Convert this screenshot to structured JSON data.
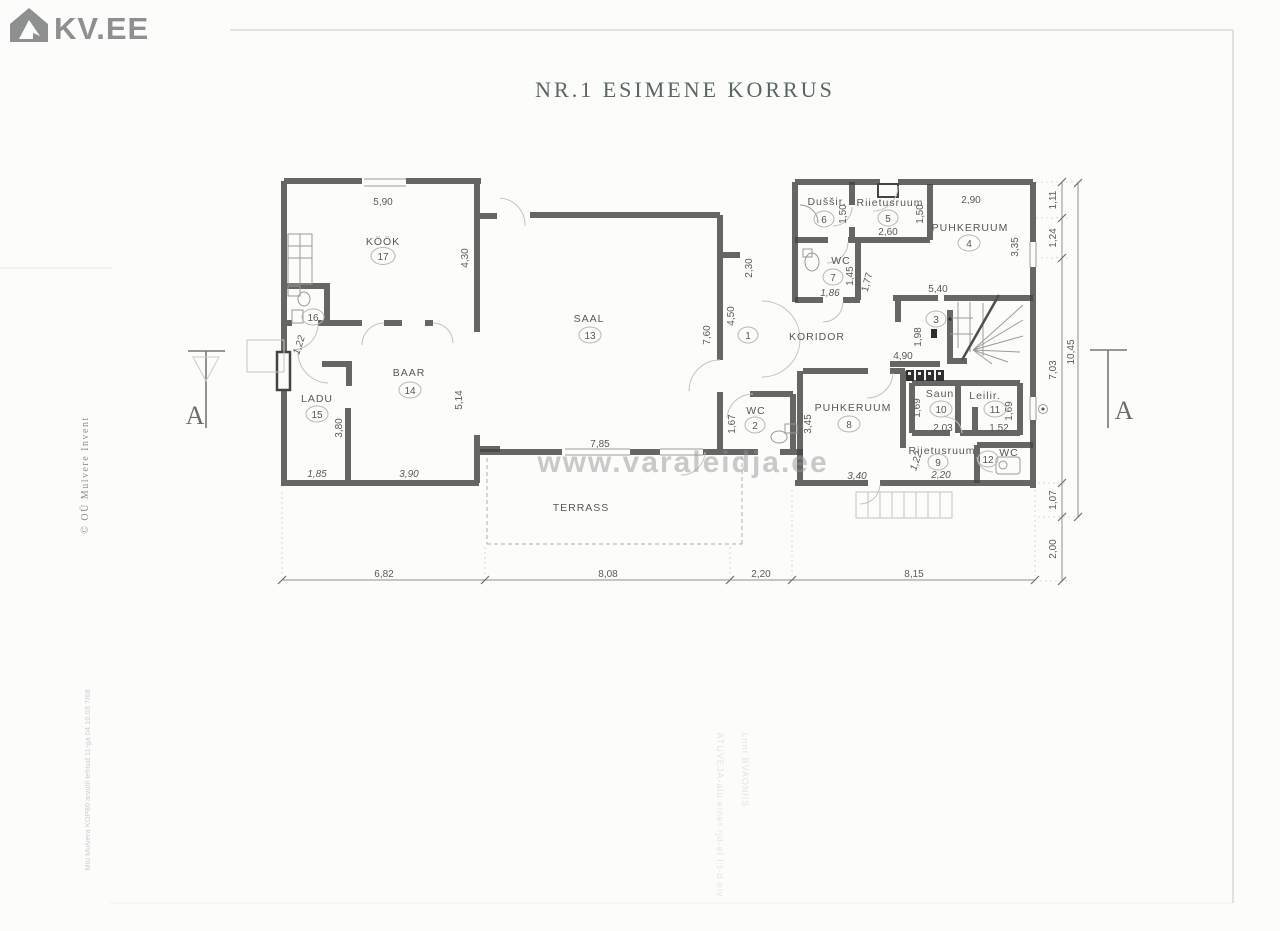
{
  "logo": {
    "brand": "KV.EE"
  },
  "title": "NR.1 ESIMENE KORRUS",
  "watermark": "www.varaleidja.ee",
  "side_notes": {
    "copyright": "© OÜ Mulvere Invent",
    "illegible_scan_left": "Mtü Mulvera KOP80 arvutil tehtud 11-ga 04.10.03 7/68",
    "illegible_scan_right_1": "ATUVEJA-alu einet rjd-el l:t-d oiv",
    "illegible_scan_right_2": "Lnnt BVAONIIS"
  },
  "section_markers": {
    "left": "A",
    "right": "A"
  },
  "rooms": {
    "koridor": {
      "name": "KORIDOR",
      "number": "1"
    },
    "wc2": {
      "name": "WC",
      "number": "2"
    },
    "room3": {
      "number": "3"
    },
    "puhkeruum4": {
      "name": "PUHKERUUM",
      "number": "4"
    },
    "riietusruum5": {
      "name": "Riietusruum",
      "number": "5"
    },
    "dusir6": {
      "name": "Duššir.",
      "number": "6"
    },
    "wc7": {
      "name": "WC",
      "number": "7"
    },
    "puhkeruum8": {
      "name": "PUHKERUUM",
      "number": "8"
    },
    "riietusruum9": {
      "name": "Riietusruum",
      "number": "9"
    },
    "saun10": {
      "name": "Saun",
      "number": "10"
    },
    "leilir11": {
      "name": "Leilir.",
      "number": "11"
    },
    "wc12": {
      "name": "WC",
      "number": "12"
    },
    "saal13": {
      "name": "SAAL",
      "number": "13"
    },
    "baar14": {
      "name": "BAAR",
      "number": "14"
    },
    "ladu15": {
      "name": "LADU",
      "number": "15"
    },
    "room16": {
      "number": "16"
    },
    "kook17": {
      "name": "KÖÖK",
      "number": "17"
    },
    "terrass": {
      "name": "TERRASS"
    }
  },
  "dimensions": {
    "kook_top": "5,90",
    "kook_right": "4,30",
    "kook_left": "1,22",
    "partition": "3,80",
    "ladu_bottom": "1,85",
    "baar_bottom": "3,90",
    "baar_right": "5,14",
    "saal_bottom": "7,85",
    "saal_right_a": "7,60",
    "saal_right_b": "4,50",
    "saal_ne": "2,30",
    "wc2_h": "1,67",
    "dusir_w": "1,50",
    "r5_right": "1,50",
    "r5_bottom": "2,60",
    "p4_top": "2,90",
    "p4_right": "3,35",
    "p4_bottom": "5,40",
    "wc7_h": "1,45",
    "wc7_bottom": "1,86",
    "passage": "1,77",
    "stair_h": "1,98",
    "stair_w": "4,90",
    "p8_left": "3,45",
    "p8_bottom": "3,40",
    "saun_left": "1,69",
    "saun_bottom": "2,03",
    "leilir_right": "1,69",
    "leilir_bottom": "1,52",
    "r9_left": "1,22",
    "r9_bottom": "2,20"
  },
  "bottom_dimensions": [
    "6,82",
    "8,08",
    "2,20",
    "8,15"
  ],
  "right_dimensions": {
    "seg1": "1,11",
    "seg2": "1,24",
    "seg3": "7,03",
    "total": "10,45",
    "seg4": "1,07",
    "seg5": "2,00"
  },
  "colors": {
    "ink": "#444444",
    "label": "#585858",
    "logo_grey": "#8d8f91",
    "title_grey_green": "#5a6663"
  }
}
